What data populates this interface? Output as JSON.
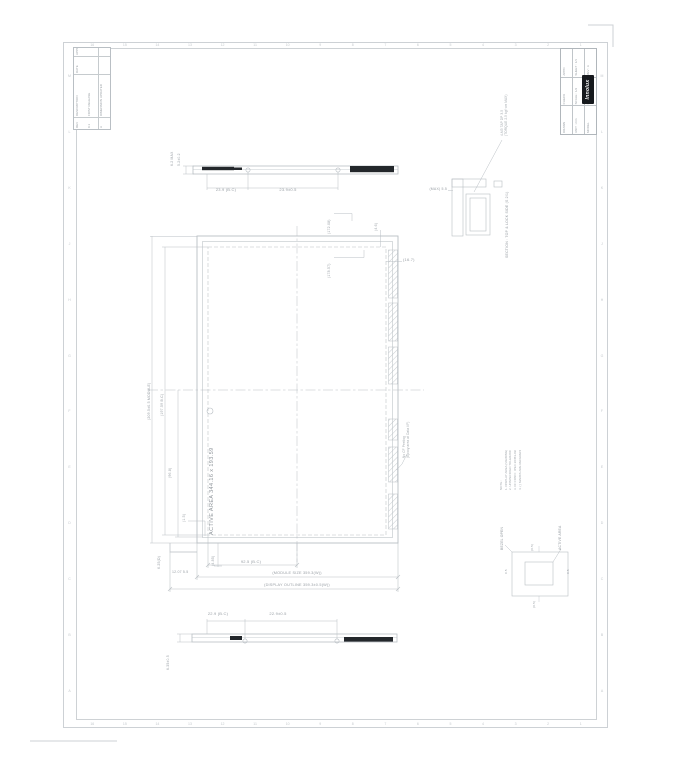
{
  "frame": {
    "zones_h": [
      "16",
      "15",
      "14",
      "13",
      "12",
      "11",
      "10",
      "9",
      "8",
      "7",
      "6",
      "5",
      "4",
      "3",
      "2",
      "1"
    ],
    "zones_v": [
      "M",
      "L",
      "K",
      "J",
      "H",
      "G",
      "F",
      "E",
      "D",
      "C",
      "B",
      "A"
    ]
  },
  "revision_table": {
    "headers": [
      "REV",
      "DESCRIPTION",
      "DATE",
      "APPD"
    ],
    "rows": [
      [
        "0.1",
        "FIRST RELEASE",
        "",
        ""
      ],
      [
        "A",
        "DIMENSION UPDATED",
        "",
        ""
      ]
    ]
  },
  "title_block": {
    "drawn": "DRAWN",
    "checked": "CHECK",
    "approved": "APPD",
    "unit": "UNIT : mm",
    "scale": "SCALE : 1/2",
    "sheet": "SHEET : 1/1",
    "model": "MODEL",
    "doc_no": "DOC. NO.",
    "rev": "REV : A",
    "logo": "Innolux"
  },
  "views": {
    "front": {
      "active_area": "ACTIVE AREA 344.16 x 193.59",
      "callout_top_1": "(172.08)",
      "callout_top_2": "(178.57)",
      "corner_gap": "(4.6)",
      "pad_width": "(16.7)",
      "pad_note": [
        "No CF Peeling",
        "(Epoxy area at Data I/F)"
      ],
      "dim_module_h": "(209.5±0.5 MODULE)",
      "dim_open_h": "(197.59 B.C)",
      "dim_half_h": "(96.8)",
      "dim_corner": "(1.5)",
      "dim_tail": "(4.85)",
      "dim_side": "6.25(D)",
      "dim_half_w": "92.5 (B.C)",
      "dim_small_w": "12.07  5.5",
      "dim_module_w": "(MODULE SIZE 359.3(W))",
      "dim_outline_w": "(DISPLAY OUTLINE 359.3±0.5(W))"
    },
    "top": {
      "dim_left": "23.9 (B.C)",
      "dim_right": "23.9±0.5",
      "thk1": "6.2 MAX",
      "thk2": "5.2±0.2"
    },
    "bottom": {
      "dim_left": "22.9 (B.C)",
      "dim_right": "22.9±0.5",
      "thk": "6.35±0.5"
    },
    "detail_c": {
      "gap": "(MAX) 5.5",
      "screw_note": [
        "4-M3 TAP DP 3.5",
        "(TORQUE 2.5 kgf·cm MAX)"
      ],
      "section_note": "SECTION : TOP & LOCK SIDE (S 2/1)"
    },
    "tolerance": {
      "left": "BEZEL OPEN",
      "right": "ACTIVE AREA",
      "top": "(0.5)",
      "bottom": "(0.5)",
      "lval": "0.5",
      "rval": "0.5"
    }
  },
  "notes": {
    "title": "NOTE :",
    "items": [
      "1. DISPLAY AREA (VIEWING) TOL ±0.5",
      "2. UNSPECIFIED TOLERANCE ±0.3",
      "3. I/F CONN : IPEX 20453-030T",
      "4. ( ) MARKS ARE REFERENCE DIM."
    ]
  }
}
